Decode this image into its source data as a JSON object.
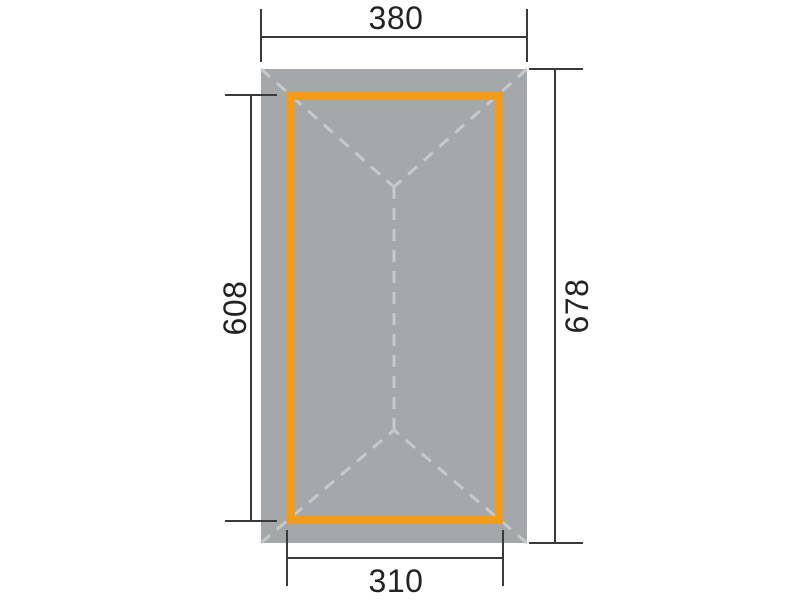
{
  "diagram": {
    "type": "dimension-plan",
    "dimensions": {
      "top": {
        "label": "380",
        "value": 380
      },
      "right": {
        "label": "678",
        "value": 678
      },
      "left": {
        "label": "608",
        "value": 608
      },
      "bottom": {
        "label": "310",
        "value": 310
      }
    },
    "colors": {
      "background": "#ffffff",
      "roof_fill": "#a6a7a8",
      "frame_stroke": "#f19c1a",
      "hip_line": "#c8c9ca",
      "dimension_line": "#3a3a3a",
      "label_text": "#232323"
    }
  }
}
